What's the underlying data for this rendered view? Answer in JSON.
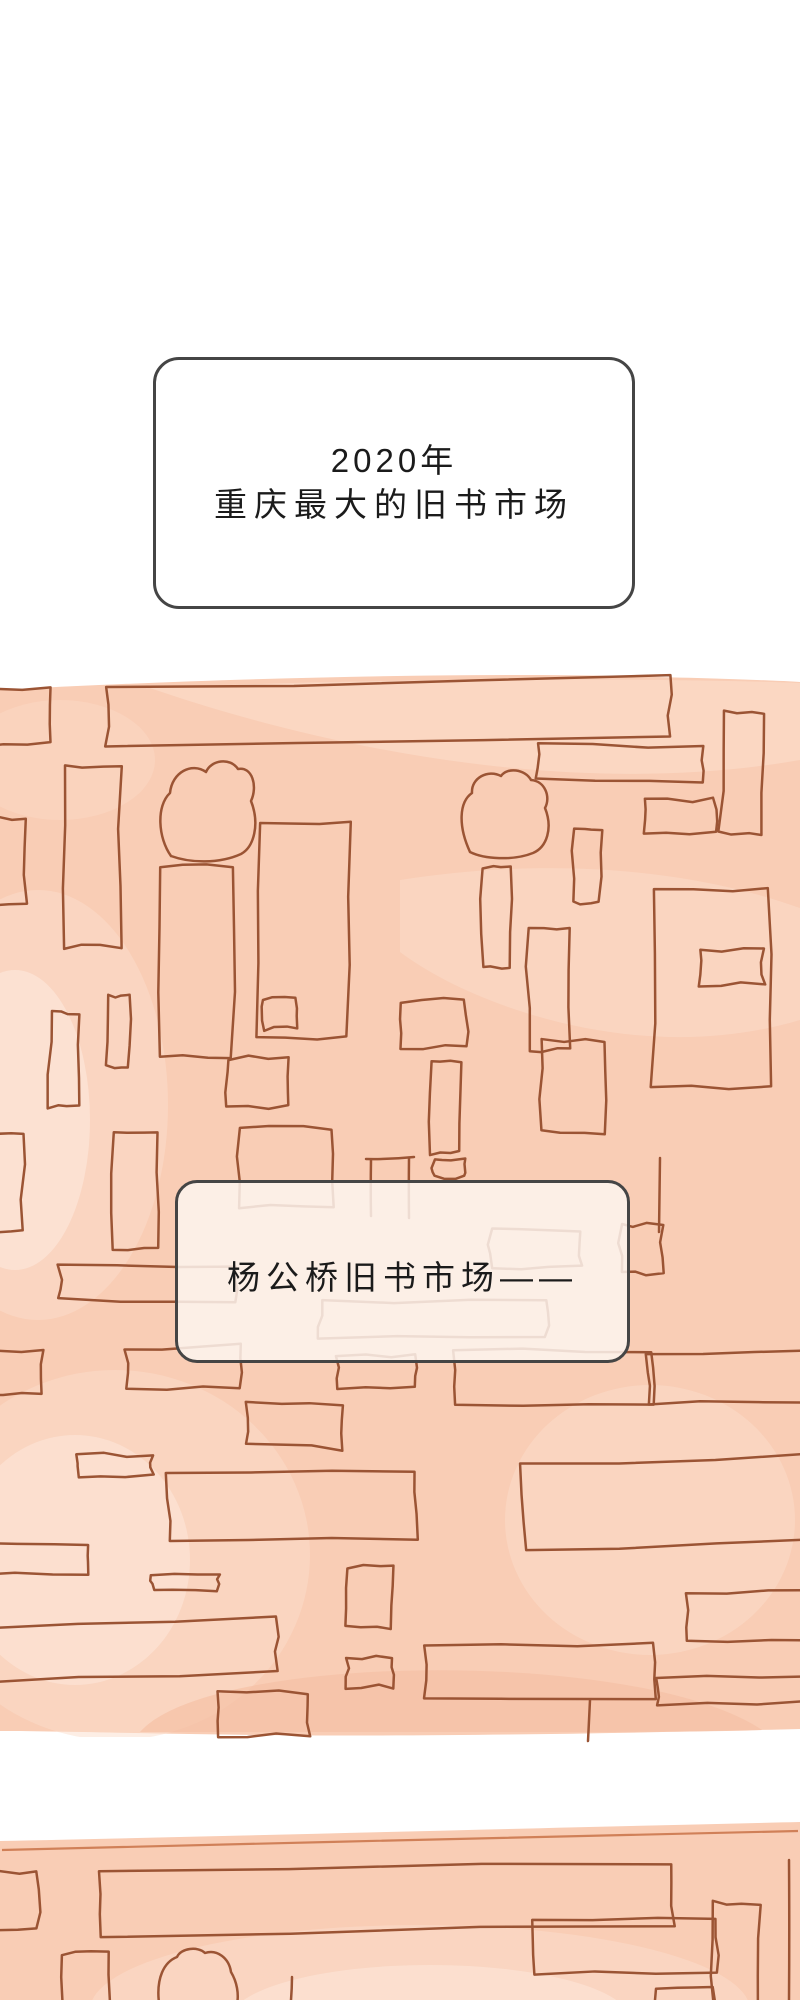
{
  "comic": {
    "caption_box": {
      "line1": "2020年",
      "line2": "重庆最大的旧书市场"
    },
    "market_label_box": {
      "text": "杨公桥旧书市场——"
    }
  },
  "art": {
    "panel1_alt": "hand-drawn sketch panel of used-book market stalls",
    "panel2_alt": "hand-drawn sketch panel of book stalls, cut off at page bottom"
  },
  "colors": {
    "page_bg": "#ffffff",
    "panel_bg": "#f9cdb5",
    "wash_light": "#fcddcb",
    "wash_lighter": "#fde9de",
    "wash_dark": "#f5c0a5",
    "sketch_line": "#9b5434",
    "panel2_top_line": "#d08058",
    "box_border": "#454545",
    "box_fill": "#ffffff",
    "label_box_fill": "rgba(253,245,238,0.85)",
    "text_color": "#1b1b1b"
  }
}
